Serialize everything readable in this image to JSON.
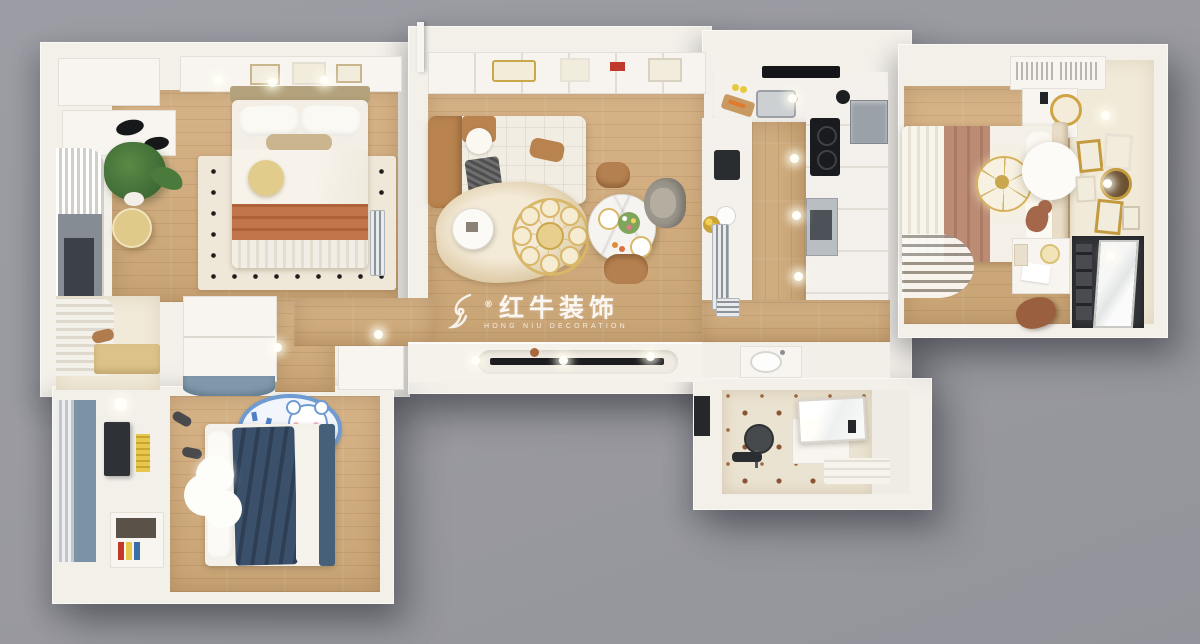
{
  "watermark": {
    "brand": "红牛装饰",
    "subtitle": "HONG NIU DECORATION",
    "registered": "®",
    "logo": "horse-head-swoosh"
  },
  "palette": {
    "background_gray": "#97979f",
    "wall_white": "#f3f0ea",
    "wood_floor": "#d2af82",
    "cream_floor": "#f1ead9",
    "caramel_accent": "#b5804f",
    "orange_blanket": "#c2754a",
    "navy_blanket": "#3b506b",
    "blue_gray": "#7f98aa",
    "gold": "#d9b769",
    "mauve_runner": "#bb8b74",
    "tile_motif_brown": "#8a5434",
    "yellow_stool": "#e0ca89"
  },
  "scene": {
    "type": "3d-rendered-floor-plan-top-view",
    "rooms": [
      "master-bedroom",
      "window-nook",
      "kids-bedroom",
      "living-dining-room",
      "hallway",
      "kitchen",
      "washbasin-area",
      "bathroom",
      "secondary-bedroom"
    ]
  }
}
